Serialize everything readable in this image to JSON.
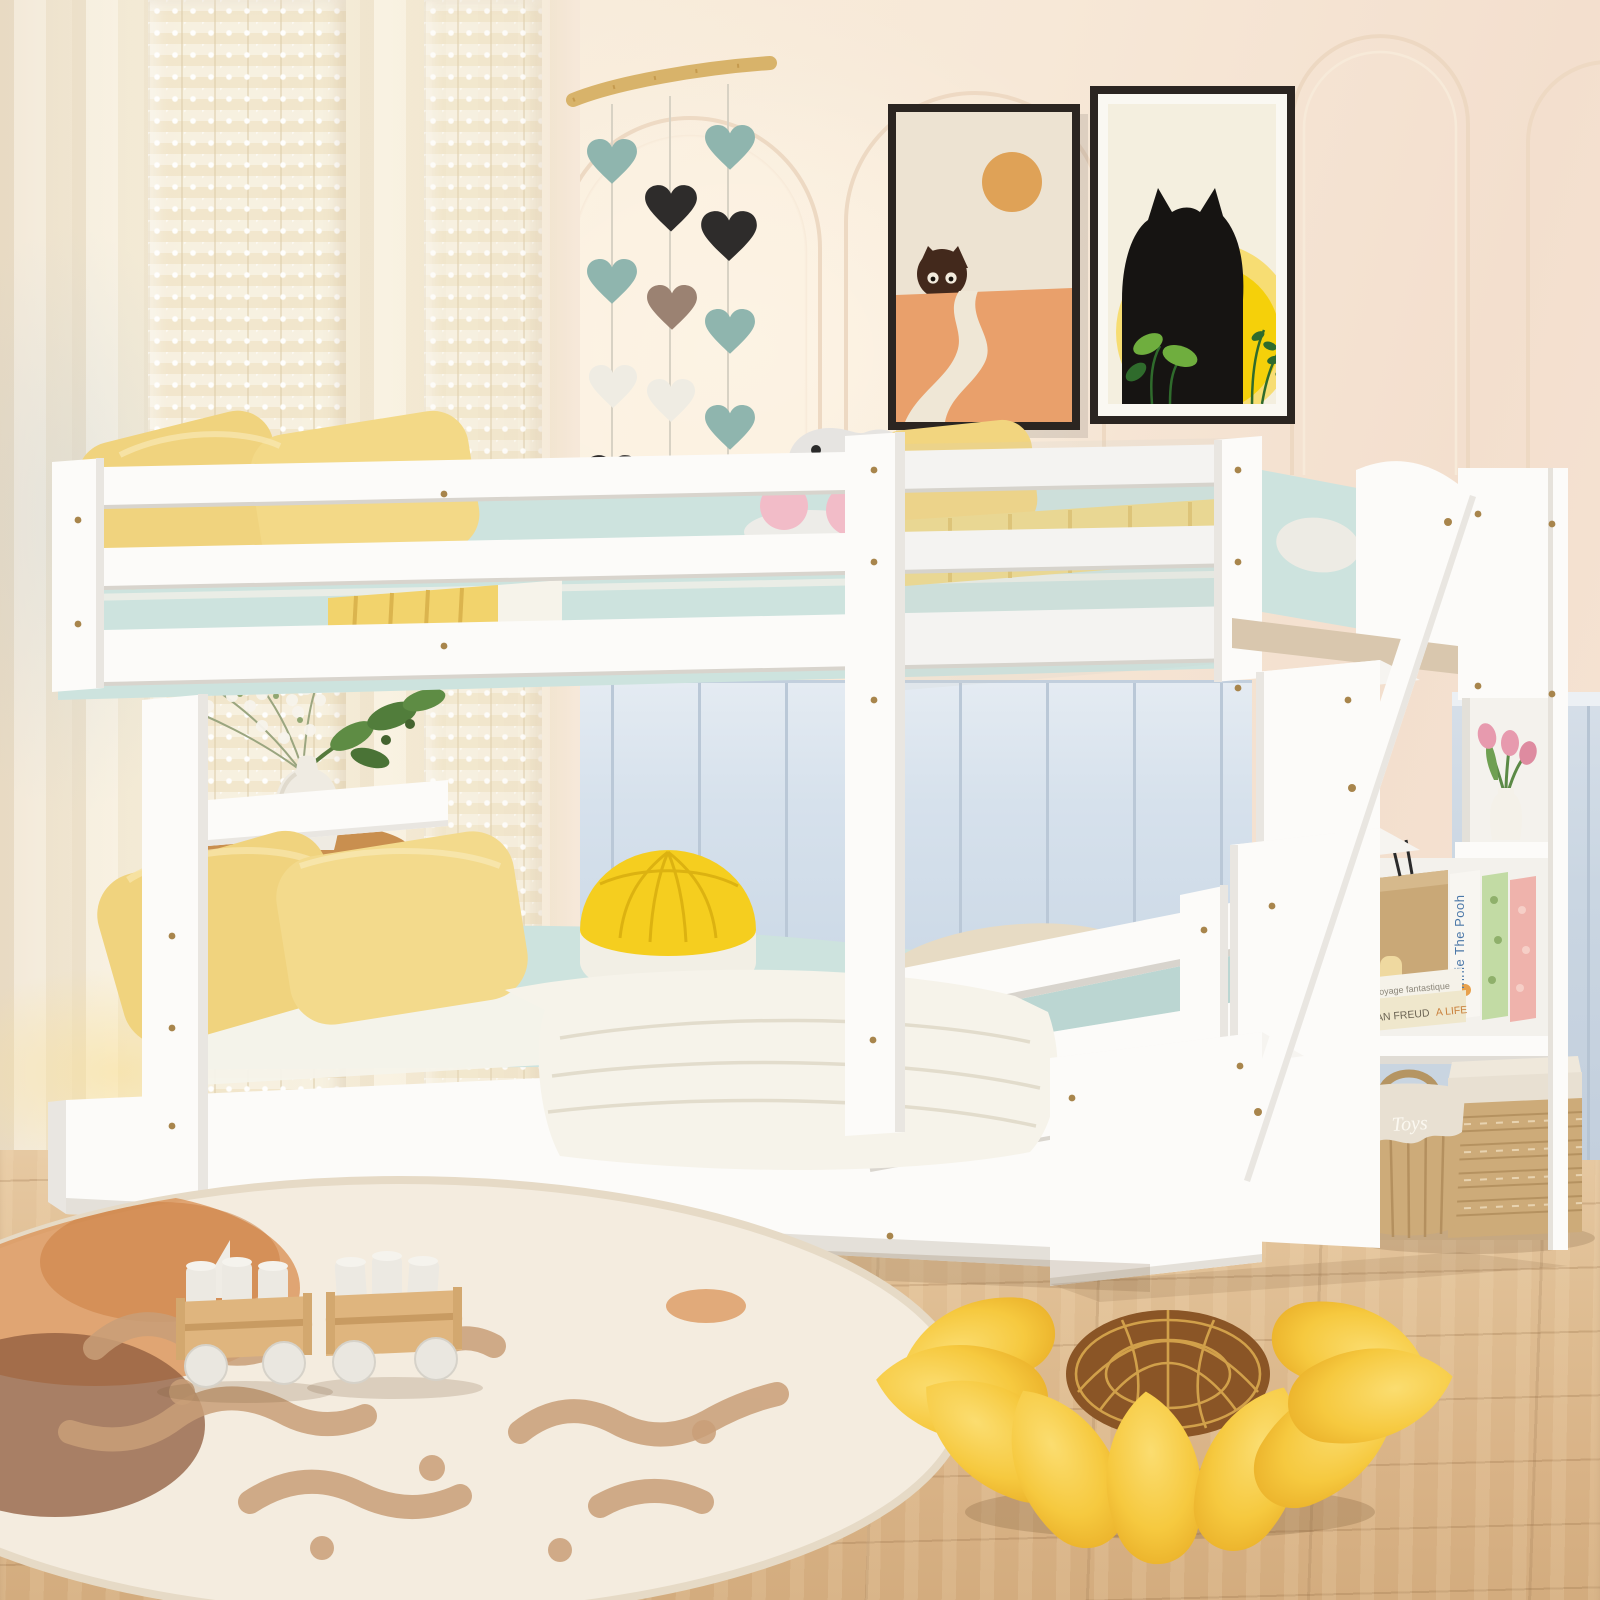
{
  "scene": {
    "description": "Product photo of a white wooden full-over-full bunk bed with storage staircase and side shelves in a pastel children's bedroom",
    "objects": [
      "sheer-lace-curtains",
      "arched-wall-moldings",
      "heart-garland-on-branch",
      "two-framed-cat-posters",
      "white-bunk-bed",
      "yellow-pillows",
      "light-blue-bedding",
      "yellow-round-pouf",
      "white-plush-toy",
      "wooden-side-table",
      "vase-with-white-flowers",
      "storage-staircase",
      "shelf-with-tulip-vase",
      "shelf-with-books",
      "wicker-baskets",
      "round-cream-rug",
      "wooden-toy-wagons",
      "sunflower-floor-pillow",
      "light-wood-floor",
      "blue-wainscot-panels"
    ]
  },
  "shelf": {
    "book_spine_vertical": "Winnie The Pooh",
    "book_stack_top": "Voyage fantastique",
    "book_stack_bottom_title": "LUCIAN FREUD",
    "book_stack_bottom_sub": "A LIFE",
    "basket_label": "Toys"
  },
  "colors": {
    "wall": "#F6E8D9",
    "arch_line": "#EDD8C2",
    "floor": "#E2C29D",
    "panel_blue": "#D3DEE9",
    "panel_blue_line": "#BAC8D7",
    "panel_right": "#C9D5E1",
    "bed_white": "#FCFBF9",
    "bed_shade": "#E9E6E1",
    "bed_dark": "#D8D4CD",
    "screw": "#A8854C",
    "bedding_blue": "#CDE3DE",
    "bedding_blue_dark": "#BBD6D2",
    "sheet_white": "#F6F3EA",
    "pillow_yellow": "#F0D37E",
    "pillow_yellow_dark": "#DDBC5F",
    "blanket_yellow": "#EFD98A",
    "pouf_yellow": "#F5CE1F",
    "heart_teal": "#8FB5AE",
    "heart_black": "#2E2C2B",
    "heart_white": "#EFECE3",
    "heart_brown": "#9B8272",
    "branch": "#D8B36A",
    "frame_dark": "#2B2521",
    "poster1_bg": "#EDE3D2",
    "poster1_sand": "#E9A06B",
    "poster1_sun": "#DFA257",
    "poster1_cat": "#43291C",
    "poster1_path": "#EFE7D6",
    "poster2_bg": "#F4EFDF",
    "poster2_sun": "#F5D00A",
    "poster2_sun_light": "#F7DD73",
    "poster2_cat": "#161412",
    "leaf": "#6FAE3E",
    "leaf_dark": "#2F6B2C",
    "table_wood": "#C98F4F",
    "table_wood_dark": "#A9713A",
    "vase": "#EFEBE2",
    "rug": "#F4ECDF",
    "rug_tan": "#C99F78",
    "rug_orange": "#D98E4F",
    "rug_brown": "#8F5B3C",
    "wicker": "#CDAB79",
    "wicker_dark": "#B08C5B",
    "linen": "#E8E0D2",
    "sunflower": "#F6C93F",
    "sunflower_dark": "#E8AC25",
    "sunflower_center": "#8A5526",
    "sunflower_line": "#D9A94F",
    "tulip": "#E79AAE",
    "plush": "#E6E4E1",
    "plush_ear": "#F2BCC8"
  }
}
